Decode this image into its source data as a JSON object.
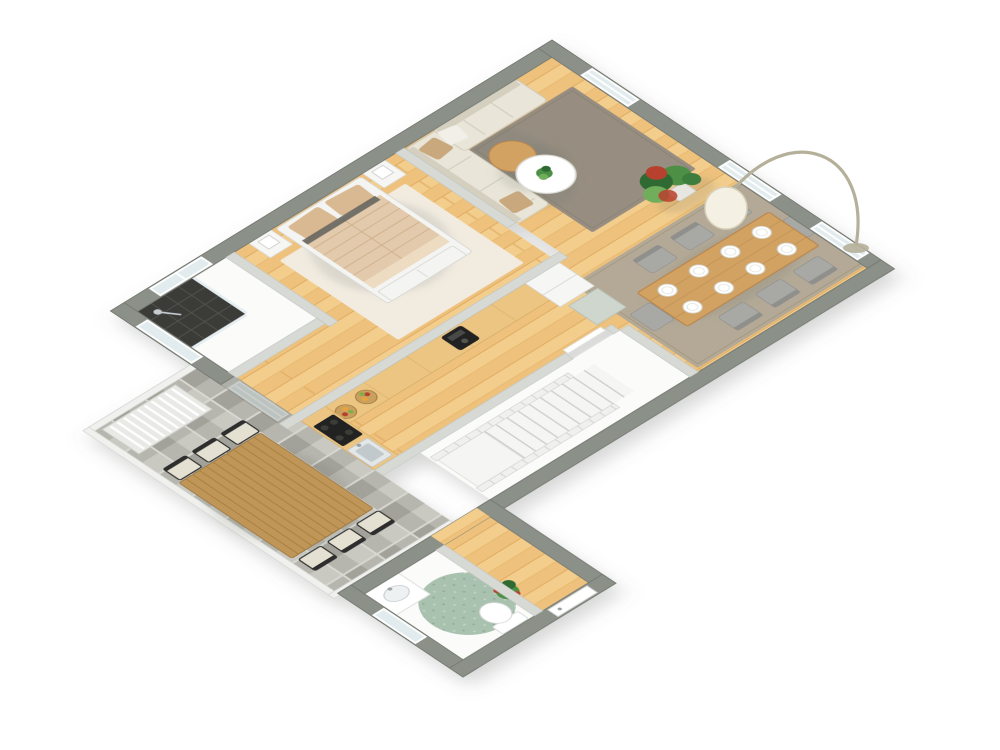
{
  "scene": {
    "type": "3d-floor-plan-render",
    "projection": "axonometric-rotated",
    "background": "#ffffff",
    "rooms": [
      {
        "name": "living-room",
        "floor": "wood",
        "items": [
          "l-shaped-sofa",
          "throw-pillows",
          "round-wood-coffee-table",
          "round-white-coffee-table",
          "small-plant",
          "area-rug",
          "window"
        ]
      },
      {
        "name": "dining-area",
        "floor": "wood",
        "items": [
          "dining-table",
          "dining-chairs",
          "place-settings",
          "arc-floor-lamp",
          "area-rug",
          "potted-plant",
          "windows"
        ]
      },
      {
        "name": "bedroom",
        "floor": "wood",
        "items": [
          "double-bed",
          "nightstand-left",
          "nightstand-right",
          "table-lamps",
          "area-rug",
          "foot-dresser"
        ]
      },
      {
        "name": "shower-room",
        "floor": "white",
        "items": [
          "dark-tiled-shower",
          "glass-partition",
          "window"
        ]
      },
      {
        "name": "kitchen",
        "floor": "wood",
        "items": [
          "l-shaped-counter",
          "coffee-machine",
          "fruit-bowls",
          "tall-cabinet",
          "cooktop",
          "sink"
        ]
      },
      {
        "name": "hallway",
        "floor": "white",
        "items": [
          "staircase",
          "stair-railings"
        ]
      },
      {
        "name": "corridor",
        "floor": "wood",
        "items": [
          "balcony-glass-door"
        ]
      },
      {
        "name": "bathroom",
        "floor": "white",
        "items": [
          "vanity-sink",
          "round-rug",
          "toilet",
          "potted-plant",
          "window"
        ]
      },
      {
        "name": "balcony",
        "floor": "stone-pavers",
        "items": [
          "outdoor-dining-table",
          "outdoor-chairs",
          "slatted-lounger",
          "railing"
        ]
      }
    ],
    "counts": {
      "dining_chairs": 8,
      "place_settings": 8,
      "balcony_chairs": 6,
      "stair_treads": 10,
      "sofa_pillows": 3,
      "windows_top_right_wall": 3
    }
  },
  "colors": {
    "bg": "#ffffff",
    "wall_outer": "#8b9089",
    "wall_outer_edge": "#747971",
    "wall_inner": "#d7dad4",
    "floor_wood": "#eec27c",
    "floor_wood_light": "#f7d699",
    "floor_wood_dark": "#d9a257",
    "floor_white": "#fbfbfa",
    "paver": "#b6b6ae",
    "paver_light": "#c9c9c2",
    "paver_dark": "#a3a29a",
    "rug_living": "#978e81",
    "rug_dining": "#b3a996",
    "rug_bedroom": "#f1ebe0",
    "rug_bath": "#a9c2af",
    "sofa": "#e9e5d8",
    "sofa_line": "#d4cfbf",
    "pillow_tan": "#c9a87e",
    "pillow_white": "#f1efe7",
    "bed_blanket": "#e3caac",
    "bed_stripe": "#d3b globale694",
    "bed_pillow": "#d9b991",
    "bed_frame": "#f4f4f2",
    "table_wood": "#d2a263",
    "table_wood_dark": "#b9854b",
    "chair_gray": "#a8a8a5",
    "chair_dark": "#8f8f8c",
    "outdoor_table": "#c09558",
    "outdoor_chair_frame": "#2f2f2d",
    "outdoor_chair_seat": "#e4e1d3",
    "counter_top": "#ecc583",
    "cabinet": "#f6f6f4",
    "appliance_dark": "#232321",
    "steel": "#c6cdd1",
    "plant_green": "#4d8f45",
    "plant_dark": "#2f6b33",
    "plant_red": "#b8402e",
    "pot": "#9a9a93",
    "shower_tile": "#3a3a38",
    "shower_grid": "#53534f",
    "glass": "#e2ecef",
    "stair": "#f5f5f3",
    "stair_shadow": "#cdd0cb",
    "rail": "#f0f1ee",
    "lamp_shade": "#f4f0e3",
    "lamp_pole": "#b5b09a",
    "shadow": "#6a6f68"
  }
}
